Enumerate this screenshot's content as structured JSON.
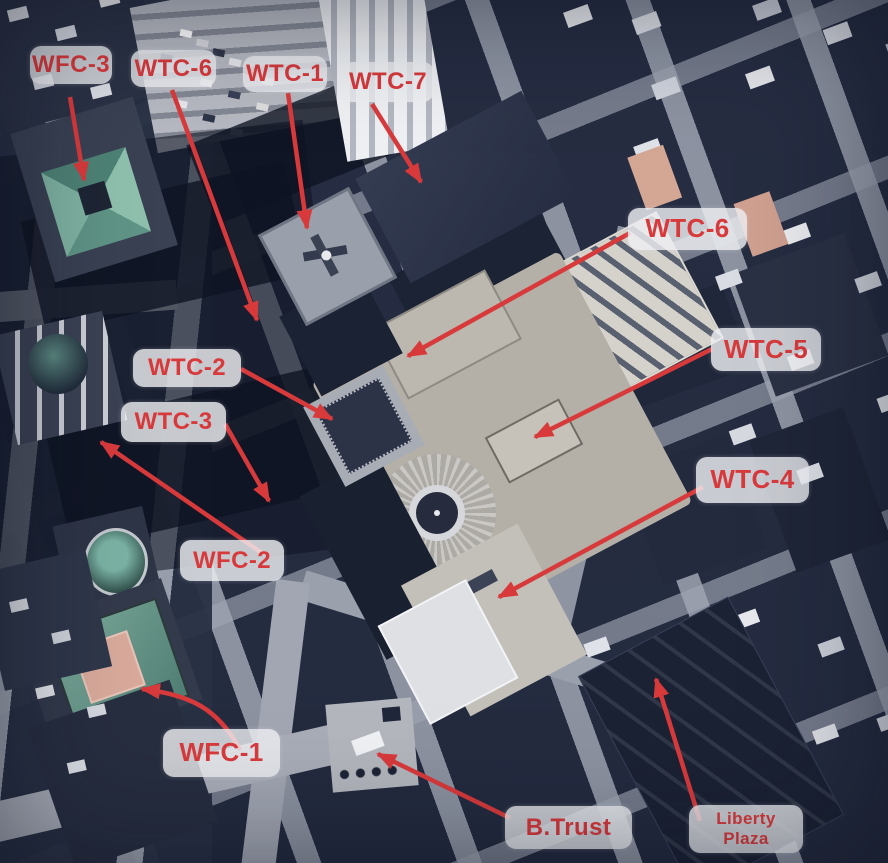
{
  "image": {
    "description": "Annotated aerial photograph of the World Trade Center complex and surrounding buildings",
    "width": 888,
    "height": 863
  },
  "colors": {
    "annotation_red": "#d83a3c",
    "label_background": "rgba(238,239,243,0.82)"
  },
  "annotations": [
    {
      "id": "wfc-3",
      "lines": [
        "WFC-3"
      ],
      "font_px": 24,
      "box": {
        "x": 30,
        "y": 46,
        "w": 82,
        "h": 38
      },
      "arrow": {
        "x1": 70,
        "y1": 97,
        "x2": 84,
        "y2": 180
      }
    },
    {
      "id": "wtc-6-upper",
      "lines": [
        "WTC-6"
      ],
      "font_px": 24,
      "box": {
        "x": 131,
        "y": 50,
        "w": 85,
        "h": 37
      },
      "arrow": {
        "x1": 172,
        "y1": 90,
        "x2": 257,
        "y2": 320
      }
    },
    {
      "id": "wtc-1",
      "lines": [
        "WTC-1"
      ],
      "font_px": 24,
      "box": {
        "x": 243,
        "y": 56,
        "w": 84,
        "h": 36
      },
      "arrow": {
        "x1": 288,
        "y1": 93,
        "x2": 307,
        "y2": 228
      }
    },
    {
      "id": "wtc-7",
      "lines": [
        "WTC-7"
      ],
      "font_px": 24,
      "box": {
        "x": 342,
        "y": 62,
        "w": 92,
        "h": 40
      },
      "arrow": {
        "x1": 372,
        "y1": 104,
        "x2": 421,
        "y2": 182
      }
    },
    {
      "id": "wtc-6-right",
      "lines": [
        "WTC-6"
      ],
      "font_px": 26,
      "box": {
        "x": 628,
        "y": 208,
        "w": 119,
        "h": 42
      },
      "arrow": {
        "x1": 630,
        "y1": 233,
        "x2": 408,
        "y2": 356
      }
    },
    {
      "id": "wtc-5",
      "lines": [
        "WTC-5"
      ],
      "font_px": 26,
      "box": {
        "x": 711,
        "y": 328,
        "w": 110,
        "h": 43
      },
      "arrow": {
        "x1": 712,
        "y1": 349,
        "x2": 535,
        "y2": 437
      }
    },
    {
      "id": "wtc-2",
      "lines": [
        "WTC-2"
      ],
      "font_px": 24,
      "box": {
        "x": 133,
        "y": 349,
        "w": 108,
        "h": 38
      },
      "arrow": {
        "x1": 241,
        "y1": 369,
        "x2": 332,
        "y2": 419
      }
    },
    {
      "id": "wtc-3",
      "lines": [
        "WTC-3"
      ],
      "font_px": 24,
      "box": {
        "x": 121,
        "y": 402,
        "w": 105,
        "h": 40
      },
      "arrow": {
        "x1": 225,
        "y1": 424,
        "x2": 269,
        "y2": 501
      }
    },
    {
      "id": "wfc-2",
      "lines": [
        "WFC-2"
      ],
      "font_px": 24,
      "box": {
        "x": 180,
        "y": 540,
        "w": 104,
        "h": 41
      },
      "arrow": {
        "x1": 262,
        "y1": 553,
        "x2": 101,
        "y2": 442
      }
    },
    {
      "id": "wtc-4",
      "lines": [
        "WTC-4"
      ],
      "font_px": 26,
      "box": {
        "x": 696,
        "y": 457,
        "w": 113,
        "h": 46
      },
      "arrow": {
        "x1": 703,
        "y1": 487,
        "x2": 499,
        "y2": 597
      }
    },
    {
      "id": "wfc-1",
      "lines": [
        "WFC-1"
      ],
      "font_px": 26,
      "box": {
        "x": 163,
        "y": 729,
        "w": 117,
        "h": 48
      },
      "arrow": {
        "path": "M 240 750 C 218 708 190 695 142 689"
      }
    },
    {
      "id": "b-trust",
      "lines": [
        "B.Trust"
      ],
      "font_px": 24,
      "box": {
        "x": 505,
        "y": 806,
        "w": 127,
        "h": 43
      },
      "arrow": {
        "x1": 510,
        "y1": 818,
        "x2": 378,
        "y2": 754
      }
    },
    {
      "id": "liberty-plaza",
      "lines": [
        "Liberty",
        "Plaza"
      ],
      "font_px": 17,
      "box": {
        "x": 689,
        "y": 805,
        "w": 114,
        "h": 48
      },
      "arrow": {
        "x1": 700,
        "y1": 821,
        "x2": 656,
        "y2": 679
      }
    }
  ]
}
